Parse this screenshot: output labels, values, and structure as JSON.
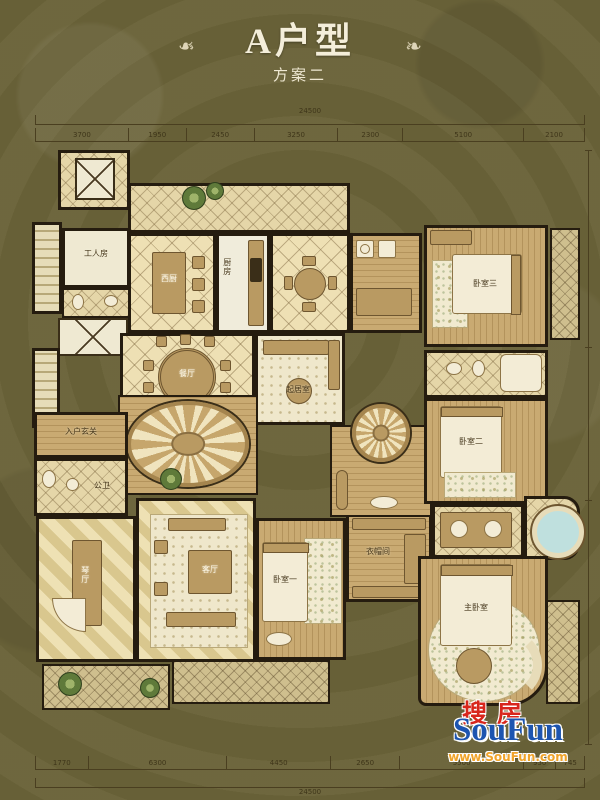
{
  "title": {
    "main": "A户型",
    "sub": "方案二",
    "ornament": "❧"
  },
  "dimensions": {
    "top_overall": "24500",
    "top_segments": [
      "3700",
      "1950",
      "2450",
      "3250",
      "2300",
      "5100",
      "2100"
    ],
    "bottom_segments": [
      "1770",
      "6300",
      "4450",
      "2650",
      "5500",
      "950",
      "745"
    ],
    "bottom_overall": "24500"
  },
  "rooms": {
    "maid": "工人房",
    "west_kitchen": "西厨",
    "kitchen": "厨房",
    "dining": "餐厅",
    "family": "起居室",
    "entry_foyer": "入户玄关",
    "guest_bath": "公卫",
    "piano": "琴厅",
    "living": "客厅",
    "bedroom1": "卧室一",
    "closet": "衣帽间",
    "bedroom2": "卧室二",
    "bedroom3": "卧室三",
    "master": "主卧室"
  },
  "watermark": {
    "cn": "搜房",
    "en": "SouFun",
    "url": "www.SouFun.com"
  },
  "colors": {
    "background": "#6b6339",
    "wall": "#251c0f",
    "floor_cream": "#eee0b4",
    "floor_wood": "#c9aa72",
    "title_text": "#f4eeda",
    "watermark_red": "#d8261c",
    "watermark_blue": "#1d55b0",
    "watermark_orange": "#f0a32a"
  }
}
